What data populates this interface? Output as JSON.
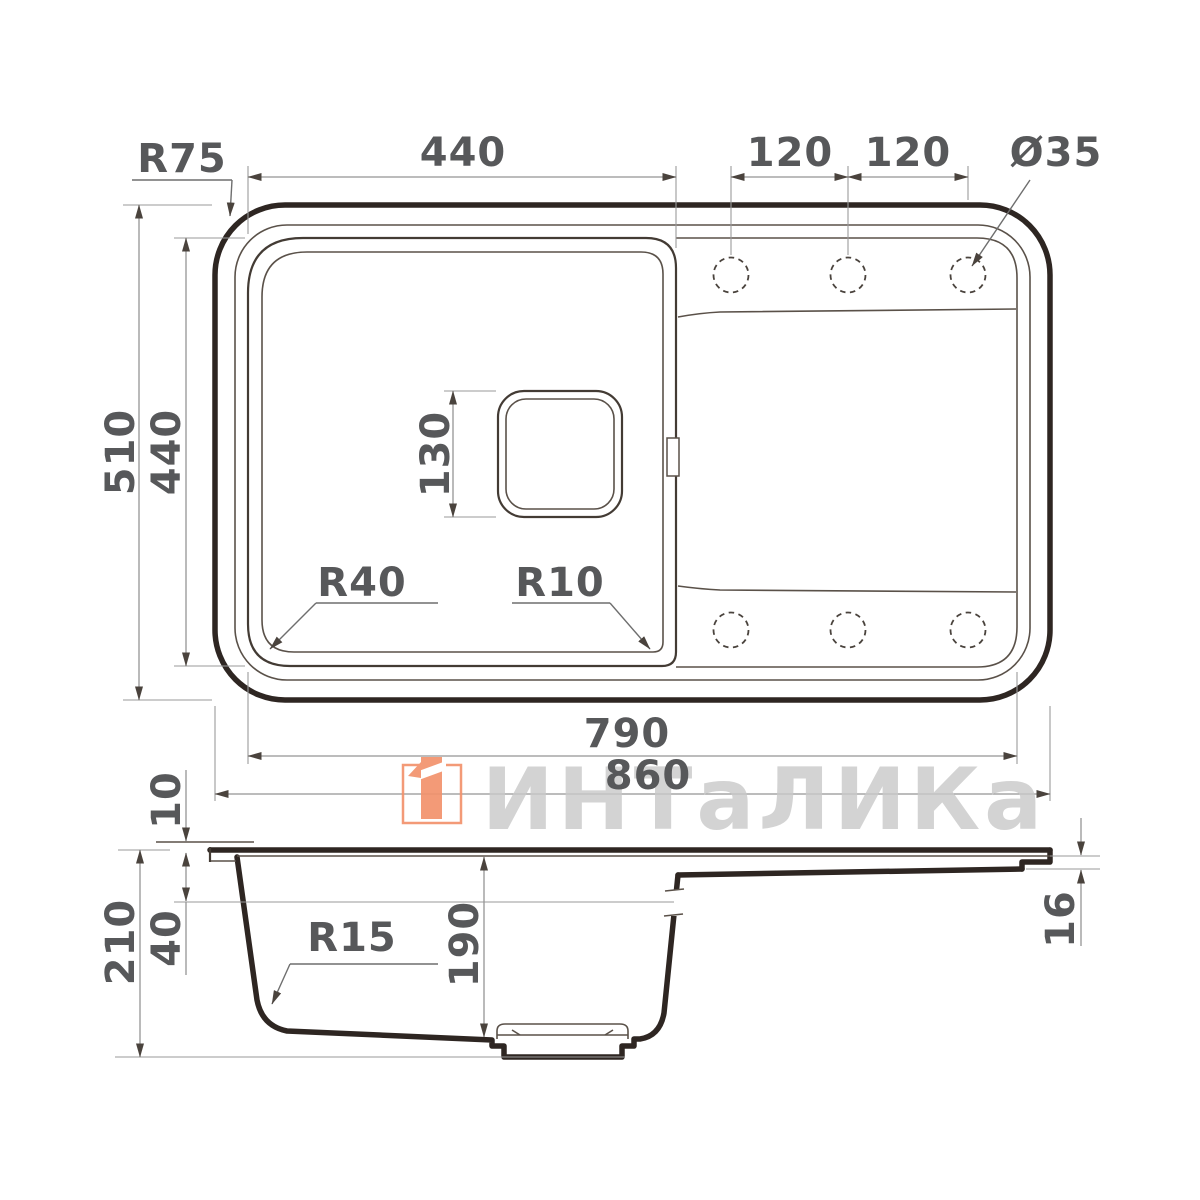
{
  "top_view": {
    "corner_radius_label": "R75",
    "bowl_width_label": "440",
    "tap_hole_spacing_1": "120",
    "tap_hole_spacing_2": "120",
    "tap_hole_diameter_label": "Ø35",
    "overall_depth_label": "510",
    "bowl_depth_label": "440",
    "drain_size_label": "130",
    "bowl_corner_radius_bottom_left": "R40",
    "bowl_corner_radius_bottom_right": "R10",
    "inner_length_label": "790",
    "overall_length_label": "860",
    "tap_hole_count": 6
  },
  "section_view": {
    "rim_height_label": "10",
    "overall_height_label": "210",
    "upper_wall_depth_label": "40",
    "bottom_corner_radius_label": "R15",
    "bowl_inner_depth_label": "190",
    "drainboard_edge_thickness_label": "16"
  },
  "watermark": {
    "brand": "ИНТаЛИКа",
    "logo_color": "#f2926c",
    "text_color": "#c9c9c9"
  },
  "style": {
    "background": "#ffffff",
    "drawing_line_color": "#2e2622",
    "thin_line_color": "#5a5149",
    "dimension_line_color": "#949494",
    "dimension_text_color": "#57585a"
  }
}
